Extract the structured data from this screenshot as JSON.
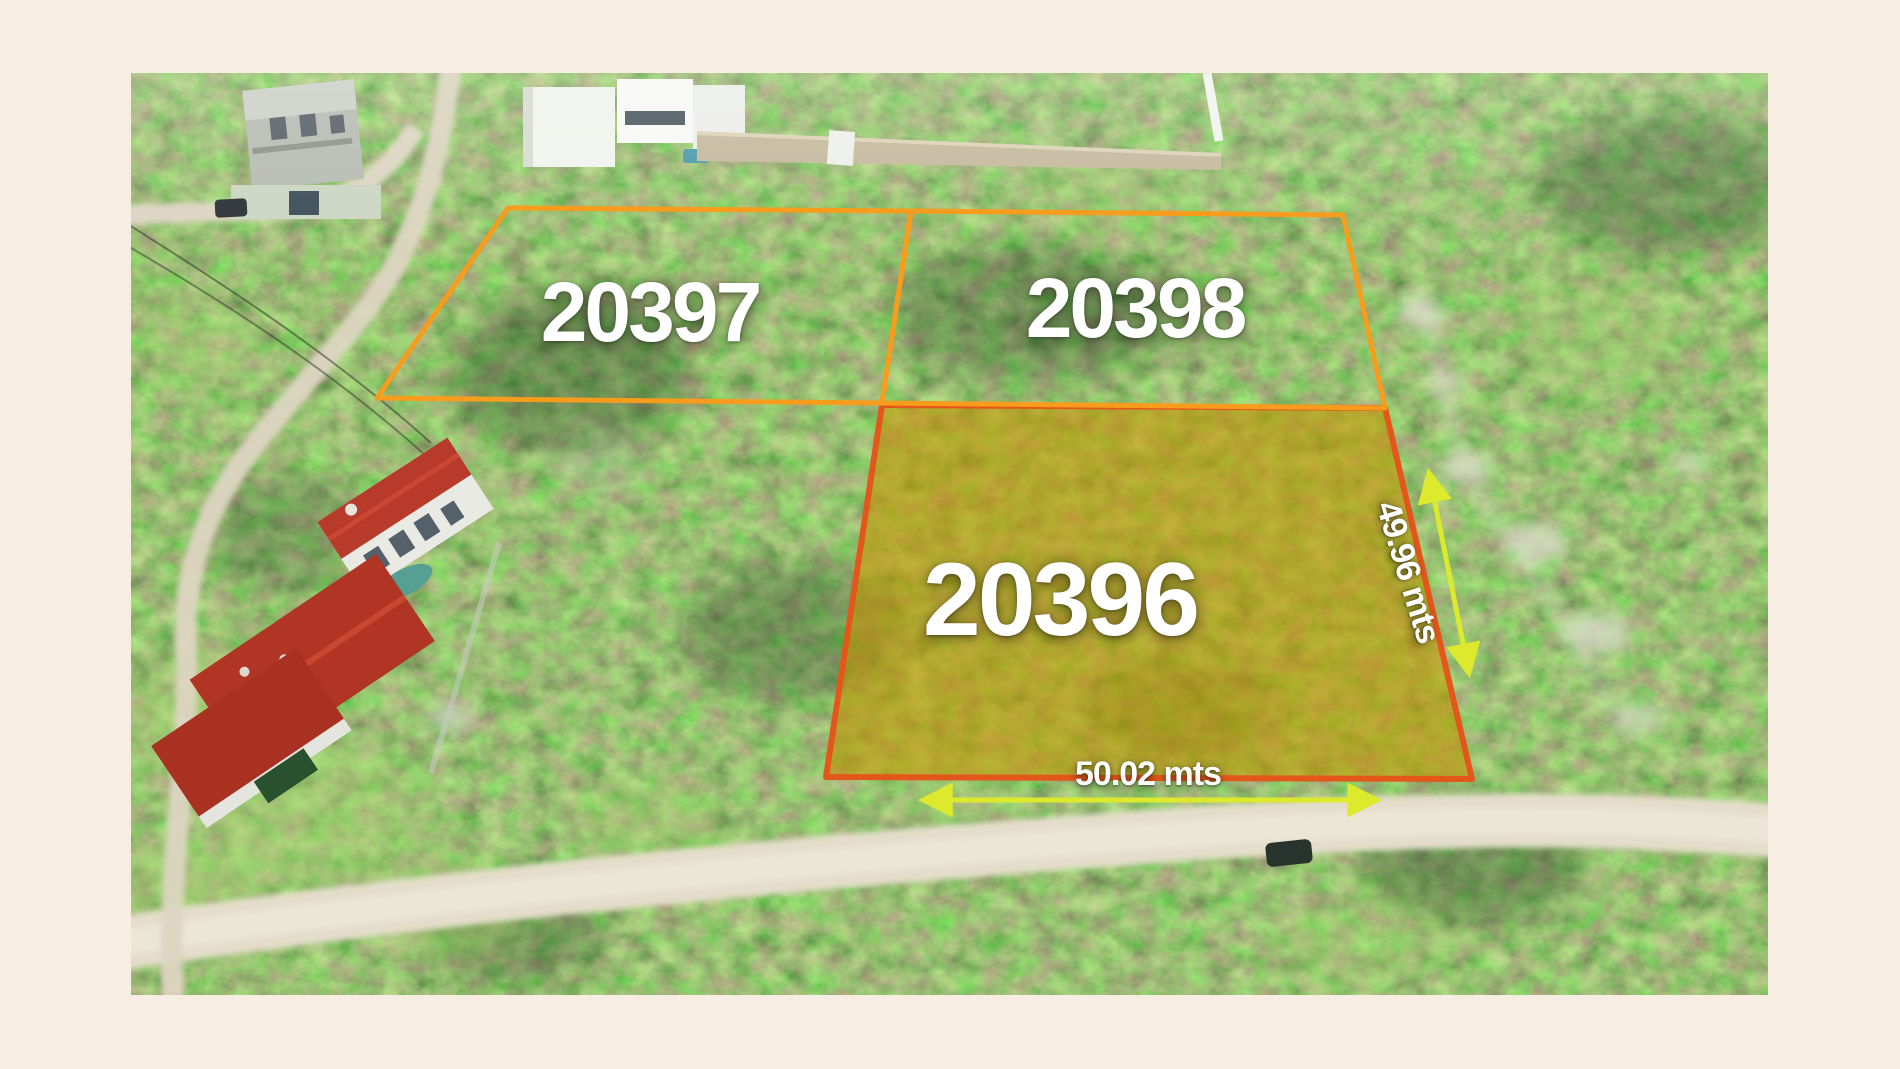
{
  "lots": {
    "lot_a": {
      "label": "20397"
    },
    "lot_b": {
      "label": "20398"
    },
    "lot_c": {
      "label": "20396"
    }
  },
  "measurements": {
    "depth": "49.96 mts",
    "width": "50.02 mts"
  },
  "colors": {
    "frame_background": "#F8EDE3",
    "lot_outline_orange": "#F79C1C",
    "highlight_outline_orange": "#E4571B",
    "highlight_fill_gold": "#C79400",
    "measurement_arrow_yellow": "#DDE92C",
    "label_white": "#FFFFFF"
  }
}
